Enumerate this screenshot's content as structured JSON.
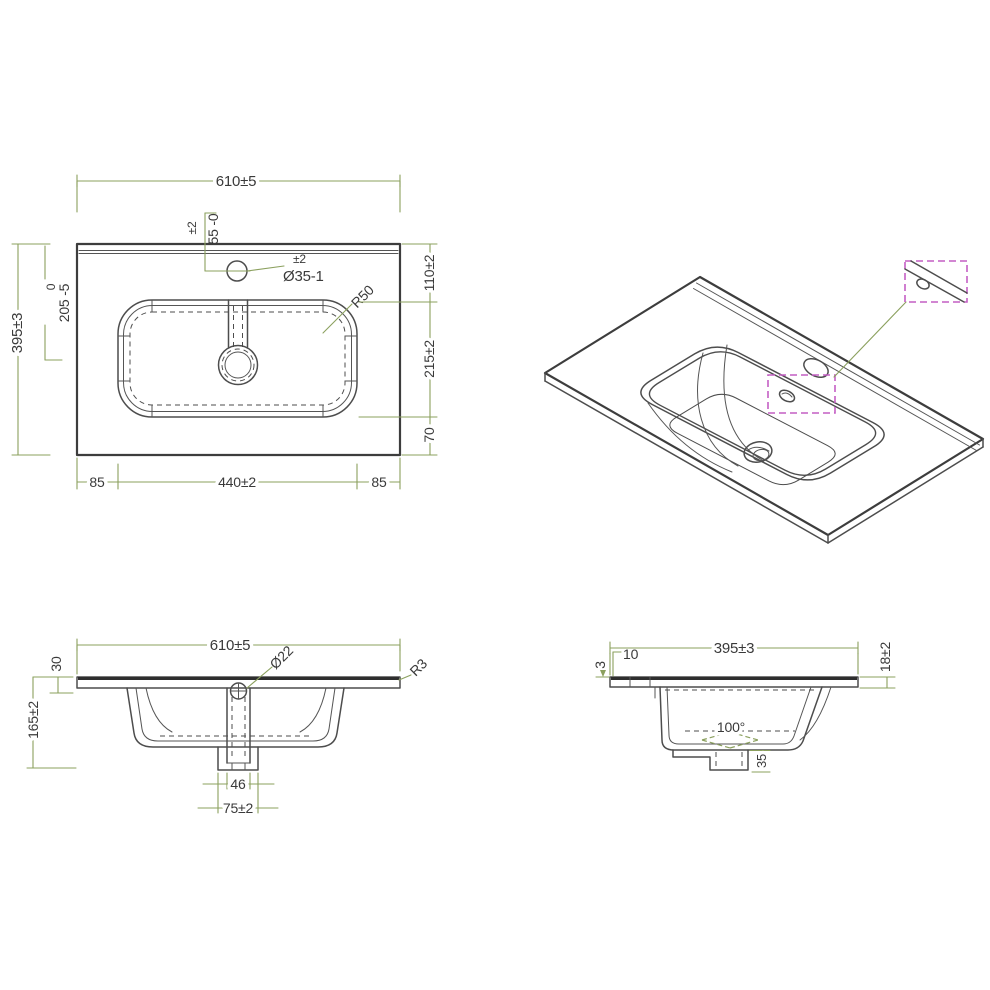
{
  "meta": {
    "drawing_type": "technical drawing - bathroom vanity basin",
    "background": "#ffffff",
    "line_color": "#4d4d4d",
    "dimension_color": "#8ba05e",
    "detail_box_color": "#c45fc4",
    "text_color": "#3a3a3a"
  },
  "plan_view": {
    "width_total": "610±5",
    "faucet_offset_tol": "±2",
    "faucet_offset": "55 -0",
    "faucet_hole_tol": "±2",
    "faucet_hole_dia": "Ø35-1",
    "basin_corner_radius": "R50",
    "back_to_basin": "110±2",
    "basin_front_to_back": "215±2",
    "basin_to_front": "70",
    "depth_total": "395±3",
    "drain_offset_tol": "0",
    "drain_offset": "205 -5",
    "margin_left": "85",
    "basin_width": "440±2",
    "margin_right": "85"
  },
  "front_section": {
    "width_total": "610±5",
    "edge_height": "30",
    "height_total": "165±2",
    "overflow_hole_dia": "Ø22",
    "edge_radius": "R3",
    "drain_channel_width": "46",
    "drain_boss_width": "75±2"
  },
  "side_section": {
    "depth_total": "395±3",
    "back_ledge": "10",
    "back_lip": "3",
    "front_edge_thickness": "18±2",
    "bowl_wall_angle": "100°",
    "drain_boss_height": "35"
  }
}
